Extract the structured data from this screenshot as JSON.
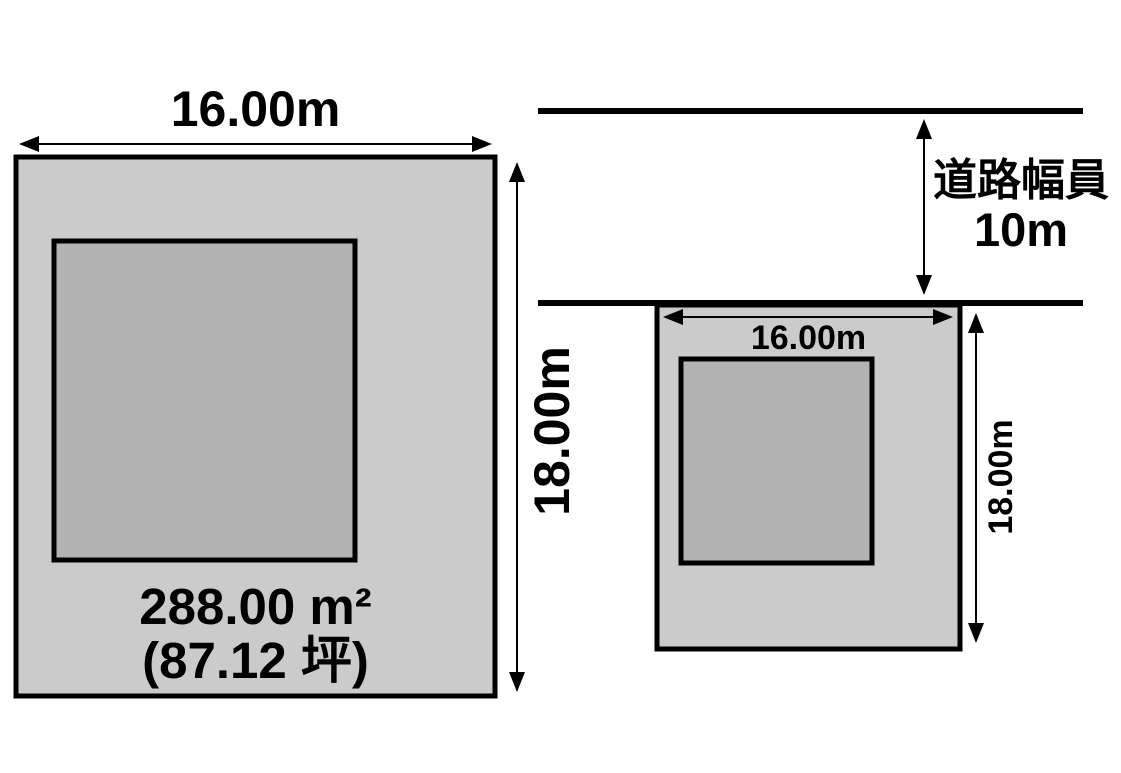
{
  "colors": {
    "plot_fill": "#cbcbcb",
    "building_fill": "#b3b3b3",
    "line": "#000000",
    "background": "#ffffff"
  },
  "left_diagram": {
    "width_label": "16.00m",
    "height_label": "18.00m",
    "area_label": "288.00 m²",
    "tsubo_label": "(87.12 坪)"
  },
  "right_diagram": {
    "road_label_line1": "道路幅員",
    "road_label_line2": "10m",
    "width_label": "16.00m",
    "height_label": "18.00m"
  }
}
